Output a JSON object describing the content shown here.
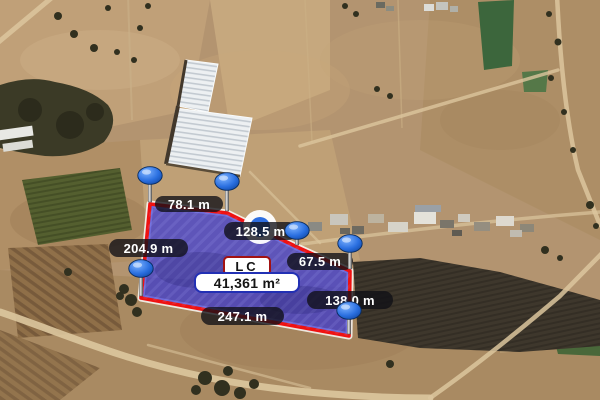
{
  "map": {
    "view": "satellite-aerial",
    "parcel": {
      "code_label": "LC",
      "area_label": "41,361 m²",
      "side_measurements": [
        "78.1 m",
        "128.5 m",
        "204.9 m",
        "67.5 m",
        "138.0 m",
        "247.1 m"
      ],
      "vertex_count": 6
    },
    "icons": {
      "vertex_pin": "balloon-pin-icon",
      "midpoint_handle": "vertex-handle-icon"
    },
    "colors": {
      "parcel_fill": "#3434d6",
      "parcel_border": "#ef1111",
      "parcel_border_halo": "#ffffff",
      "pin_blue": "#2a6fe0",
      "handle_inner_blue": "#2e6ee0",
      "measure_label_bg": "rgba(16,16,22,0.78)",
      "code_badge_border": "#a21212",
      "area_badge_border": "#2230b4"
    }
  }
}
